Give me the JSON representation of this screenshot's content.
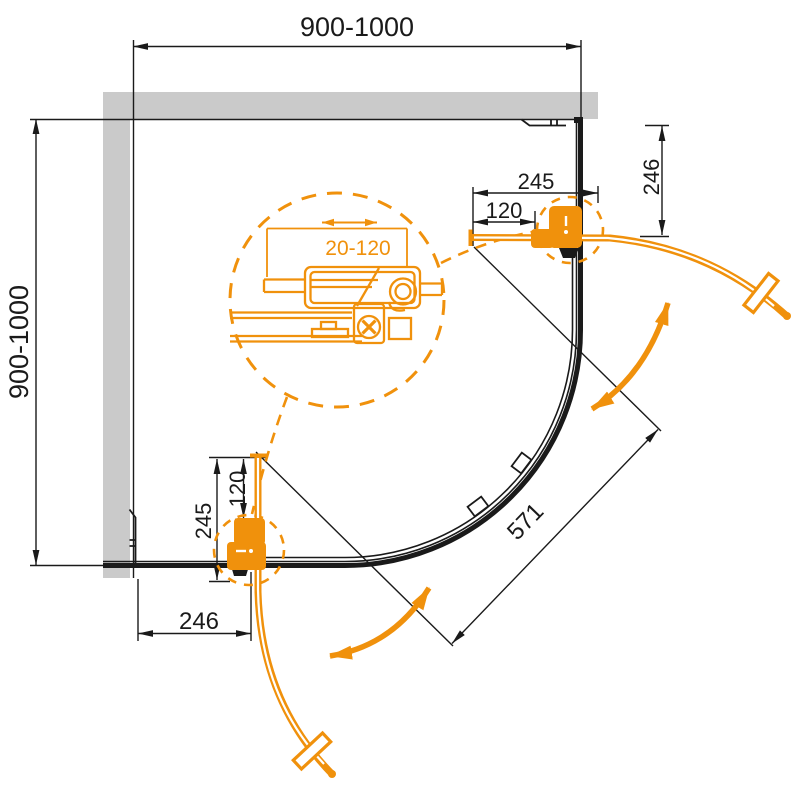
{
  "drawing": {
    "type": "shower-enclosure-plan-view",
    "labels": {
      "width": "900-1000",
      "depth": "900-1000",
      "chord": "571",
      "adjustment": "20-120",
      "top_door": {
        "edge_offset": "245",
        "handle_offset": "120",
        "wall_offset": "246"
      },
      "bottom_door": {
        "edge_offset": "245",
        "handle_offset": "120",
        "wall_offset": "246"
      }
    },
    "colors": {
      "accent_orange": "#F0910C",
      "wall_gray": "#CACACA",
      "line_black": "#1A1A1A"
    }
  }
}
